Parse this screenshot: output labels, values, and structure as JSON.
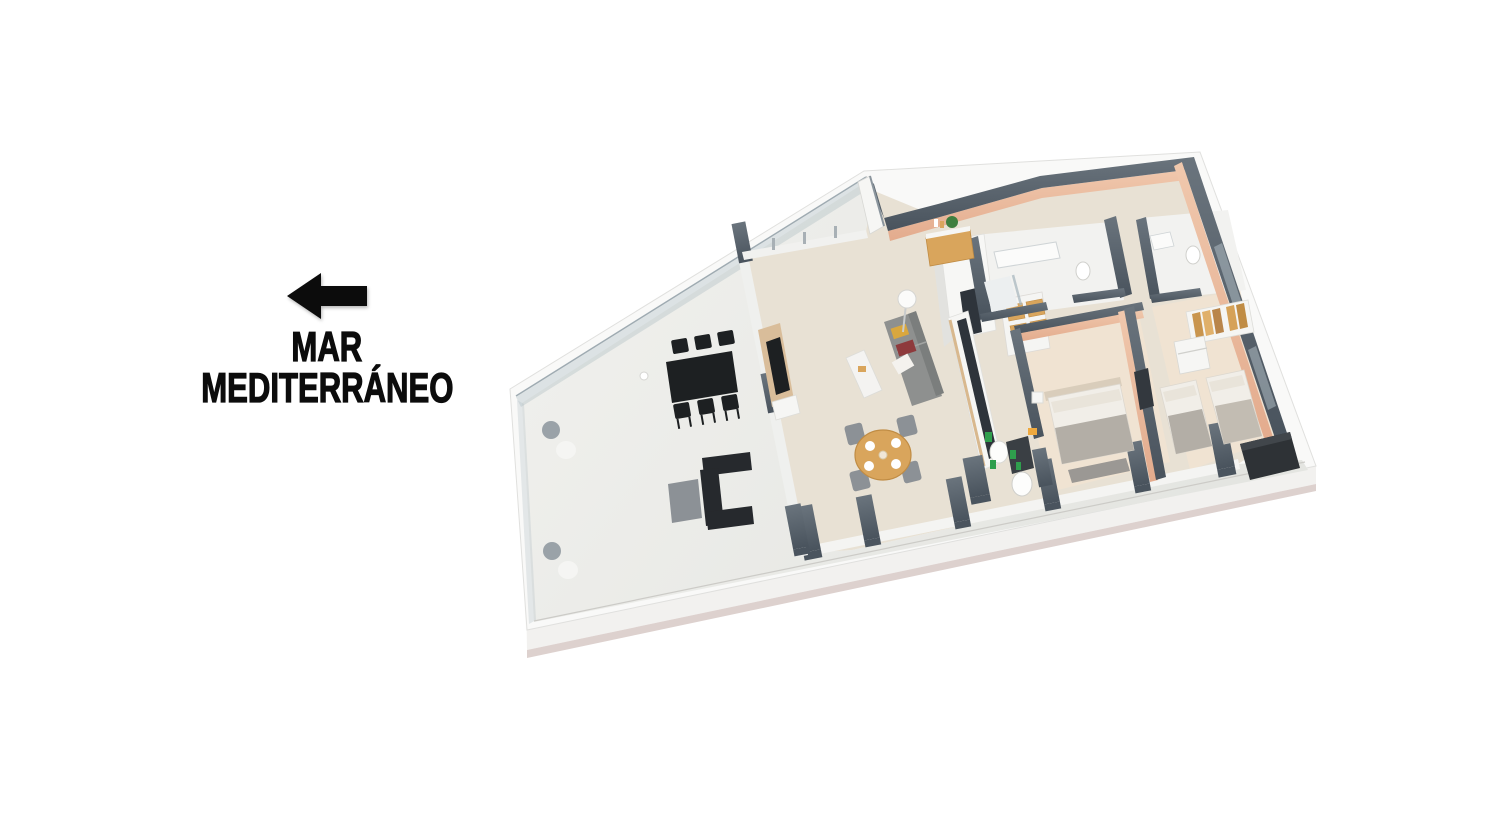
{
  "scene": {
    "kind": "3d-rendered-floor-plan",
    "background": "#ffffff"
  },
  "annotation": {
    "arrow_icon": "left-arrow",
    "line1": "MAR",
    "line2": "MEDITERRÁNEO",
    "text_color": "#0c0c0c"
  },
  "floorplan": {
    "areas": [
      "terrace",
      "living-room",
      "dining-area",
      "kitchen",
      "entrance-hall",
      "bathroom-1",
      "bathroom-2",
      "master-bedroom",
      "bedroom-2",
      "hallway"
    ],
    "furniture": [
      "outdoor-dining-table",
      "outdoor-chairs",
      "outdoor-lounge-sofa",
      "outdoor-ottoman",
      "terrace-floor-lights",
      "planters",
      "sofa",
      "coffee-table",
      "floor-lamp",
      "tv-panel",
      "dining-table",
      "dining-chairs",
      "kitchen-island",
      "kitchen-shelves",
      "entry-sideboard",
      "vanity",
      "toilet",
      "shower",
      "double-bed",
      "single-beds",
      "wardrobe",
      "dresser",
      "ac-unit"
    ],
    "colors": {
      "slab_fascia": "#f9f9f8",
      "slab_side": "#f2f1ef",
      "slab_base_strip": "#ddd1ce",
      "terrace_floor_light": "#f1f1ee",
      "terrace_floor_dark": "#e4e5e1",
      "interior_floor": "#e8e1d4",
      "bedroom_floor": "#f0e3d2",
      "bathroom_floor": "#f2f2f0",
      "wall_cap_dark": "#49535d",
      "wall_cap_light": "#6a747d",
      "wall_white": "#f3f3f1",
      "wall_peach_light": "#f0c8ad",
      "wall_peach_dark": "#e3ab8d",
      "glass": "#aebcc3",
      "wood": "#d9a55c",
      "wood_dark": "#c08c44",
      "furniture_black": "#1d2022",
      "furniture_gray": "#8c9196",
      "sofa_gray": "#8e908f",
      "cushion_mustard": "#d9a73e",
      "cushion_maroon": "#8e3a3c",
      "bed_linen": "#f1eee8",
      "blanket_gray": "#b3aea6",
      "headboard": "#d9cdbb",
      "counter_dark": "#2e343b",
      "accent_green": "#2f9e4d",
      "accent_orange": "#efa93e"
    }
  }
}
